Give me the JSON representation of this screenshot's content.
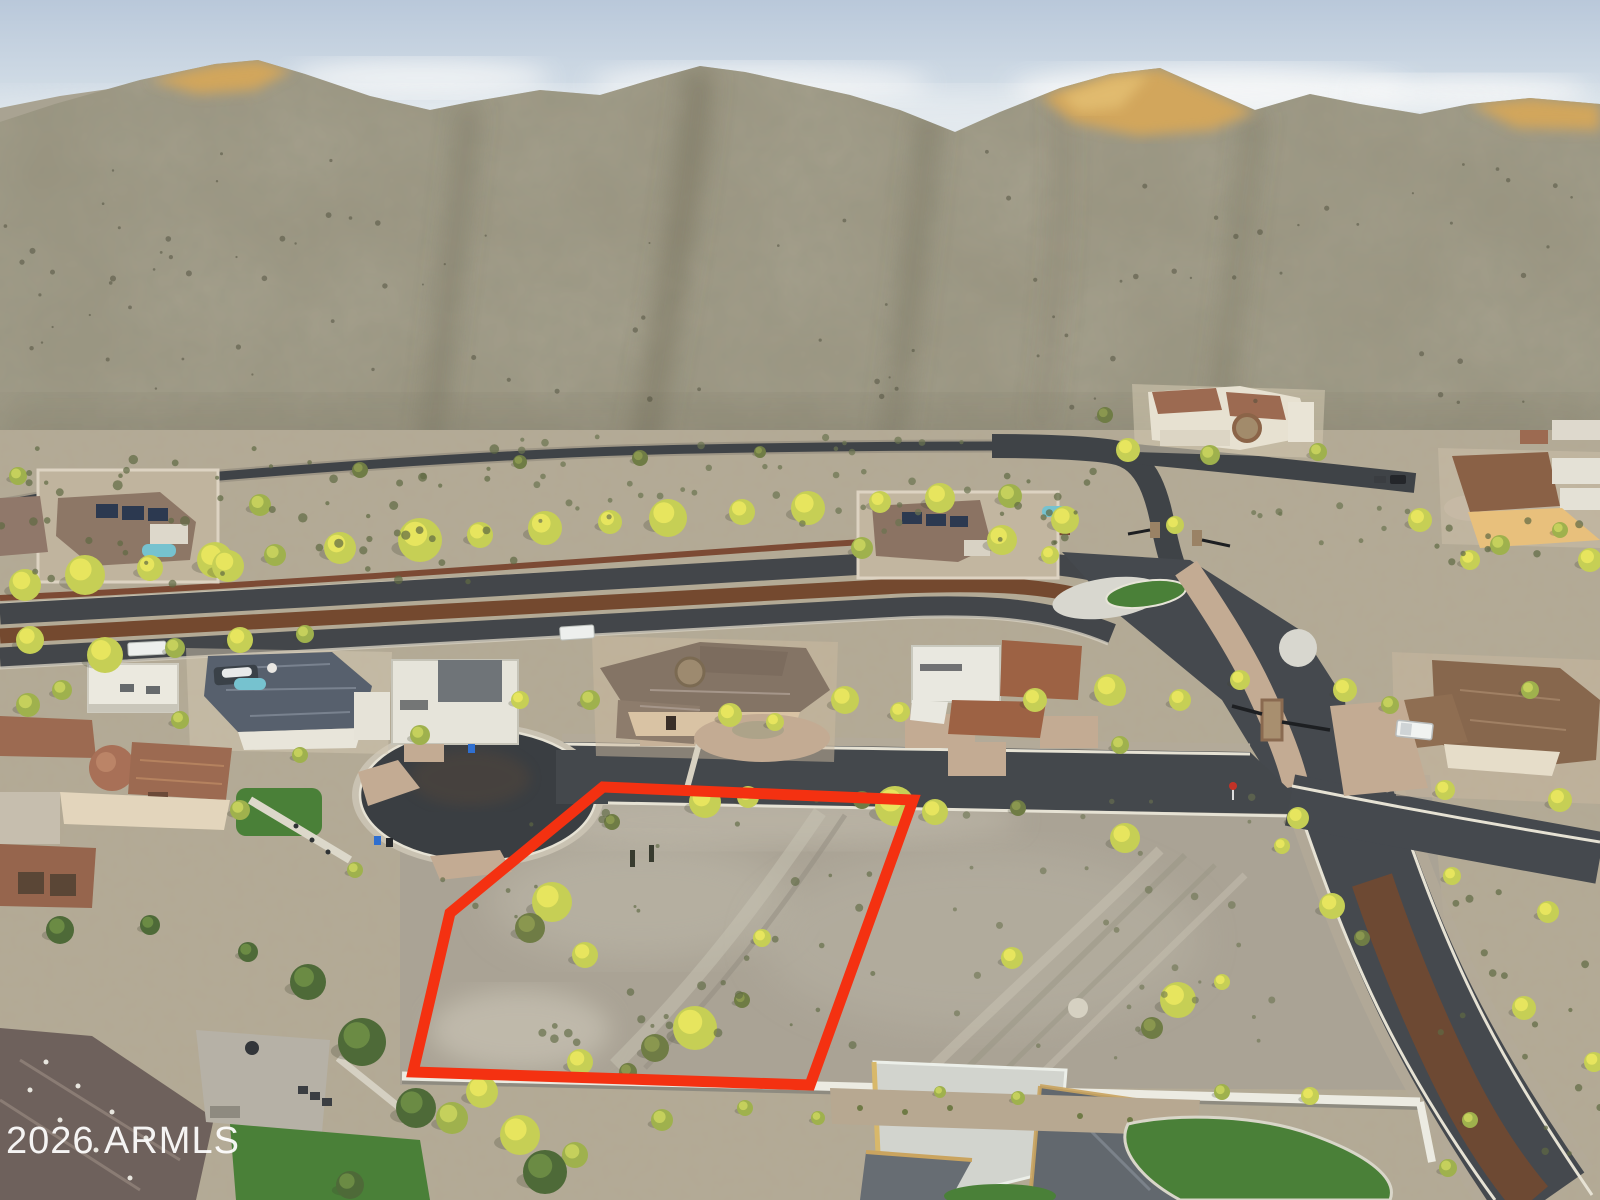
{
  "watermark": {
    "text": "2026 ARMLS"
  },
  "lot": {
    "boundary_points": "603,787 913,800 810,1085 413,1072 450,913",
    "outline_width": 11
  },
  "colors": {
    "sky_top": "#b9c8da",
    "sky_horizon": "#e9edef",
    "cloud": "#f7f8f8",
    "mountain": "#98927e",
    "mountain_shadow": "#6f6b56",
    "mountain_gold": "#d2a65c",
    "desert": "#b3a994",
    "lot_ground": "#a8a295",
    "asphalt": "#3d4145",
    "asphalt_light": "#4a4e52",
    "road_median_brown": "#74492f",
    "paver": "#c3ab93",
    "concrete": "#d8d7cf",
    "curb": "#e6e2d4",
    "wall_cream": "#ddd3c2",
    "wall_rust": "#7c4a34",
    "wall_white": "#ecebe2",
    "tree_bright": "#c6cf55",
    "tree_mid": "#9fb14d",
    "tree_olive": "#6f7c45",
    "tree_dark": "#4e6a38",
    "turf": "#4a8038",
    "tile_roof": "#9c6a51",
    "slate_roof": "#57606d",
    "gray_roof": "#62686e",
    "white_roof": "#e9e8e0",
    "stucco_tan": "#d9c3a4",
    "pool_water": "#76c2cf",
    "lot_outline": "#f43111",
    "watermark_white": "#ffffff",
    "truck_white": "#f1f3f1",
    "bin_blue": "#2f6fd0"
  }
}
